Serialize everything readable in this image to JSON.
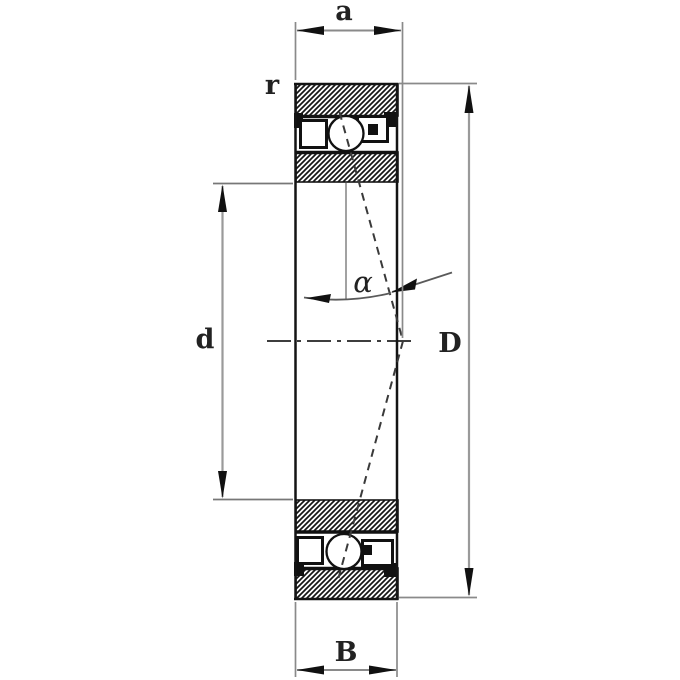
{
  "figure": {
    "background": "#ffffff",
    "outline_color": "#1a1a1a",
    "dimension_color": "#8a8a8a",
    "text_color": "#222222",
    "dimensions": {
      "a": {
        "label": "a"
      },
      "r": {
        "label": "r"
      },
      "alpha": {
        "label": "α"
      },
      "d": {
        "label": "d"
      },
      "D": {
        "label": "D"
      },
      "B": {
        "label": "B"
      }
    }
  }
}
